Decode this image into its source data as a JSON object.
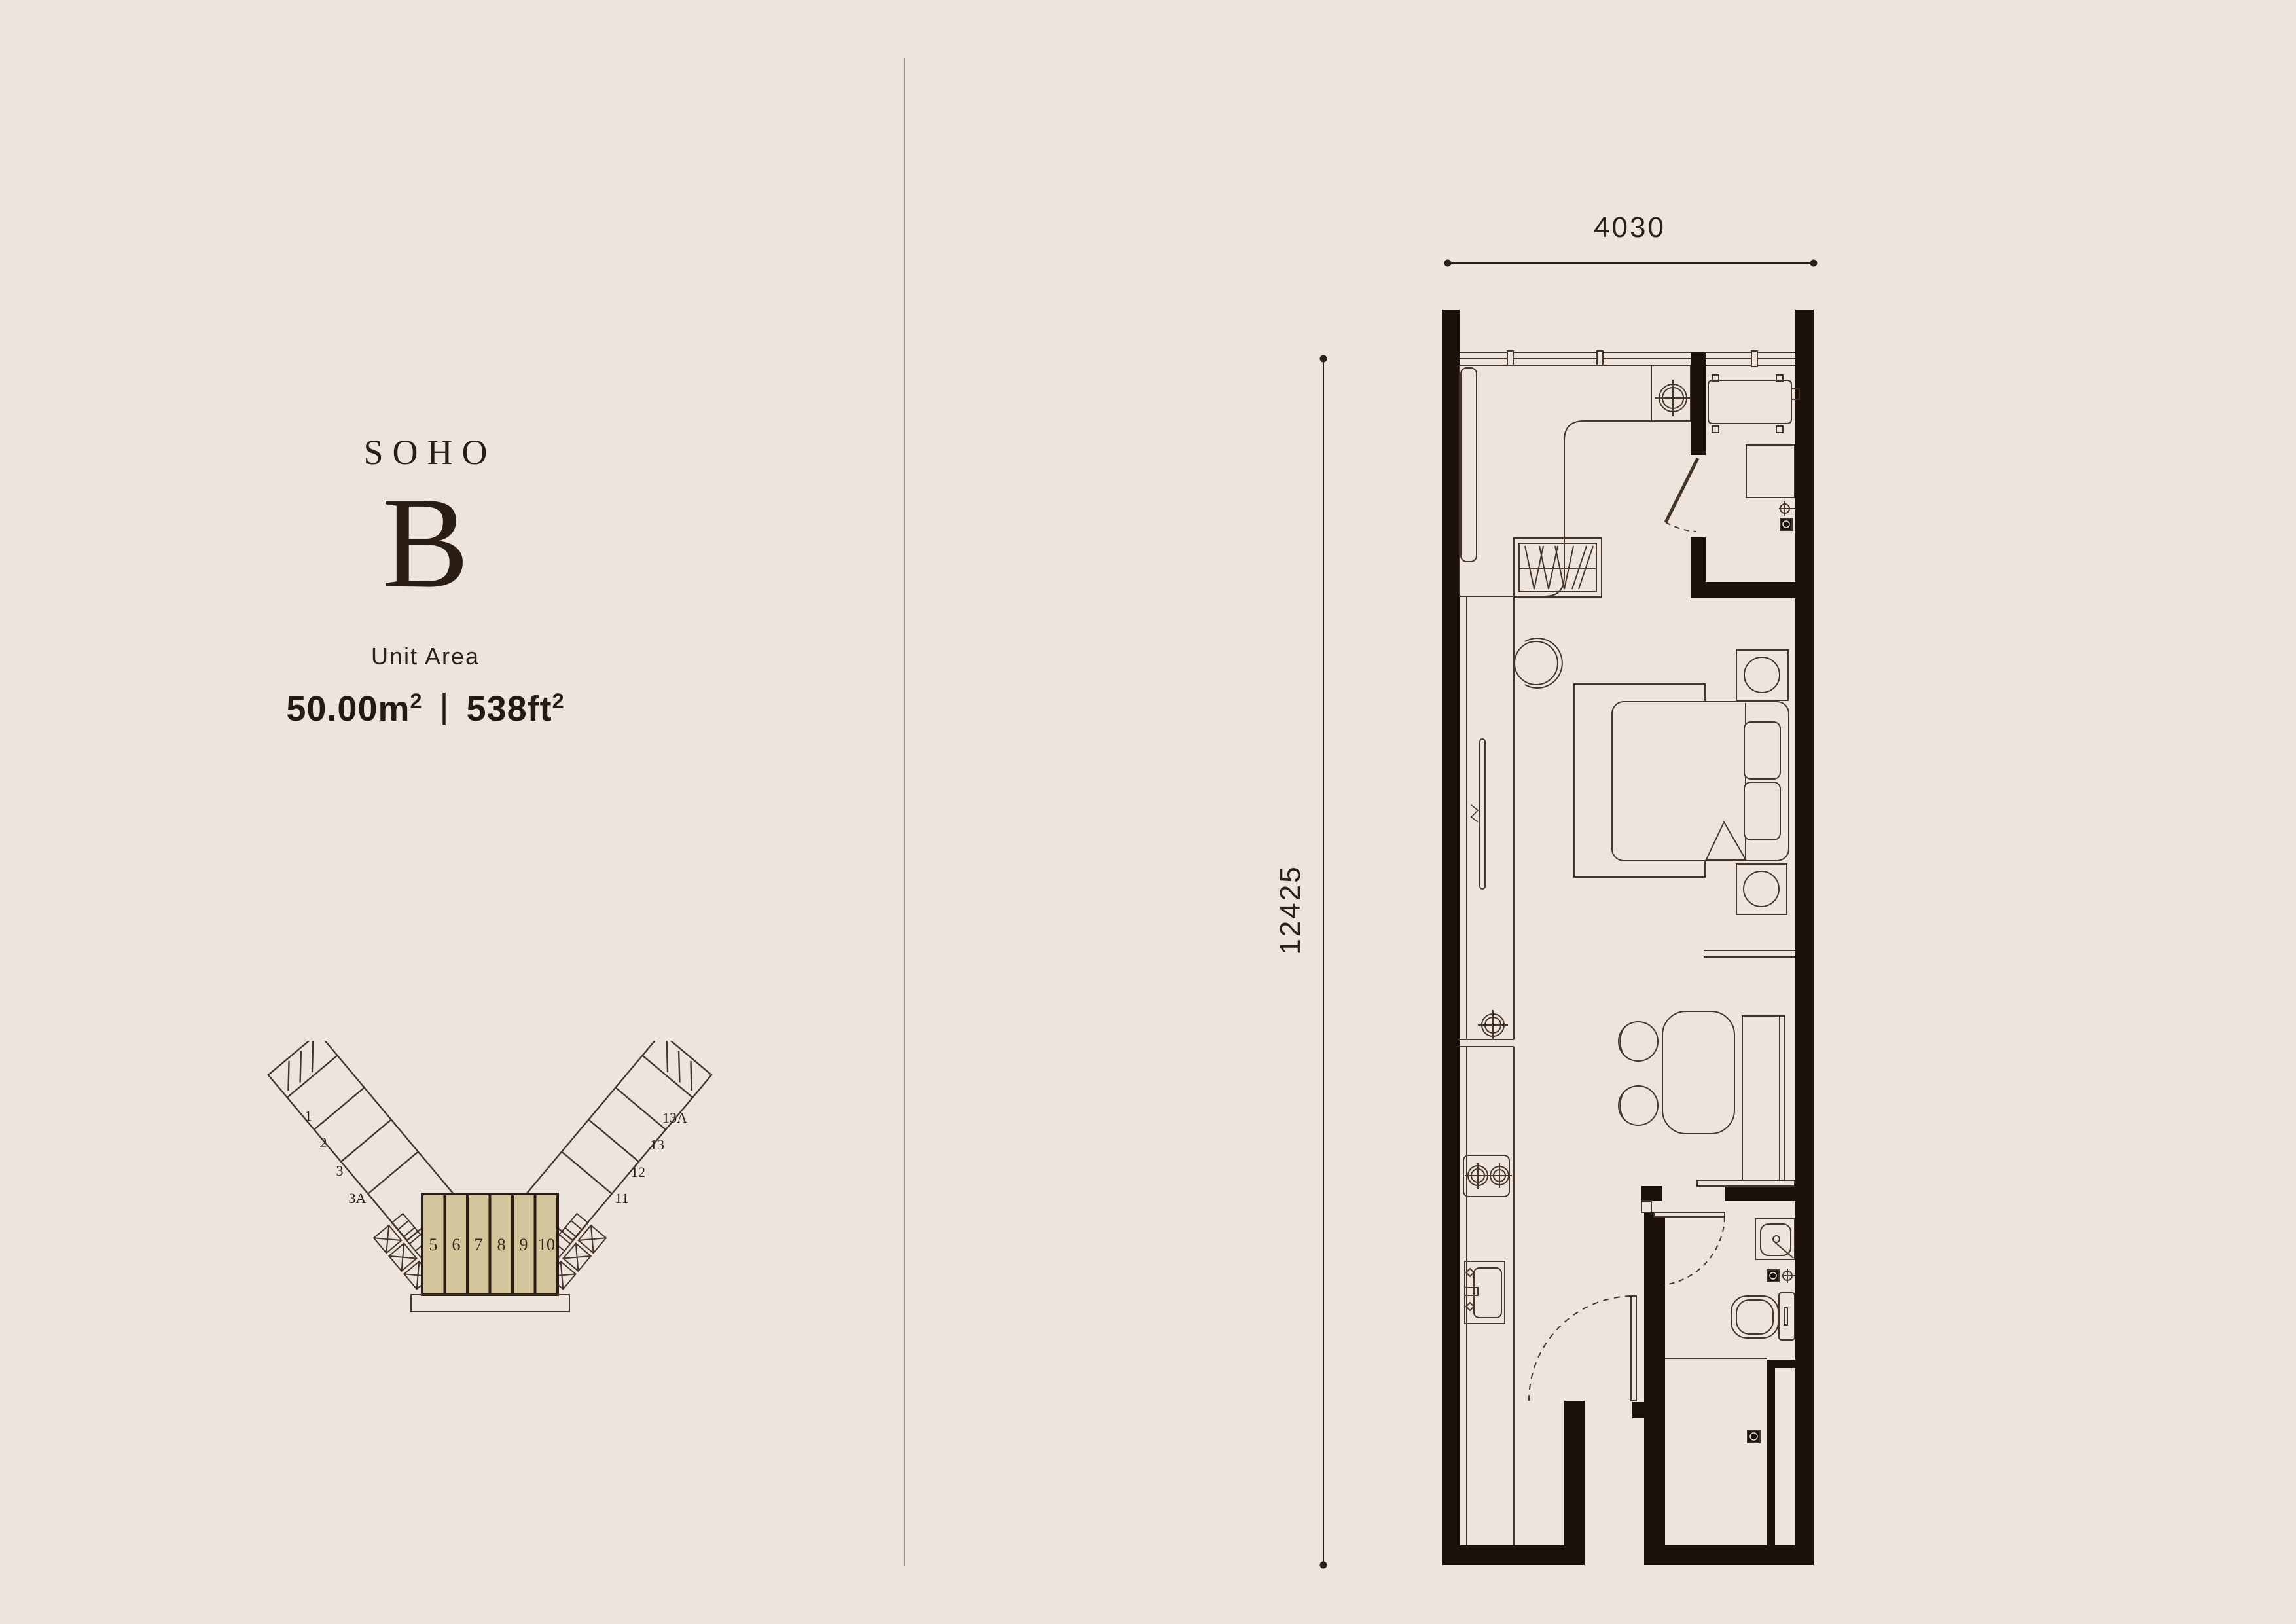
{
  "title": {
    "brand": "SOHO",
    "unit_letter": "B"
  },
  "unit_area": {
    "label": "Unit Area",
    "metric": {
      "num": "50.00",
      "unit": "m",
      "sup": "2"
    },
    "separator": "|",
    "imperial": {
      "num": "538",
      "unit": "ft",
      "sup": "2"
    }
  },
  "dimensions": {
    "width_mm": "4030",
    "height_mm": "12425"
  },
  "keyplan": {
    "center_units": [
      "5",
      "6",
      "7",
      "8",
      "9",
      "10"
    ],
    "left_units": [
      "1",
      "2",
      "3",
      "3A"
    ],
    "right_units": [
      "13A",
      "13",
      "12",
      "11"
    ],
    "highlight_color": "#d5c59c"
  },
  "colors": {
    "page_bg": "#ece4dd",
    "wall": "#1c110a",
    "furniture_line": "#453528",
    "dimension": "#2a201a",
    "divider": "#9c8c7f",
    "title_text": "#2a1d13"
  }
}
